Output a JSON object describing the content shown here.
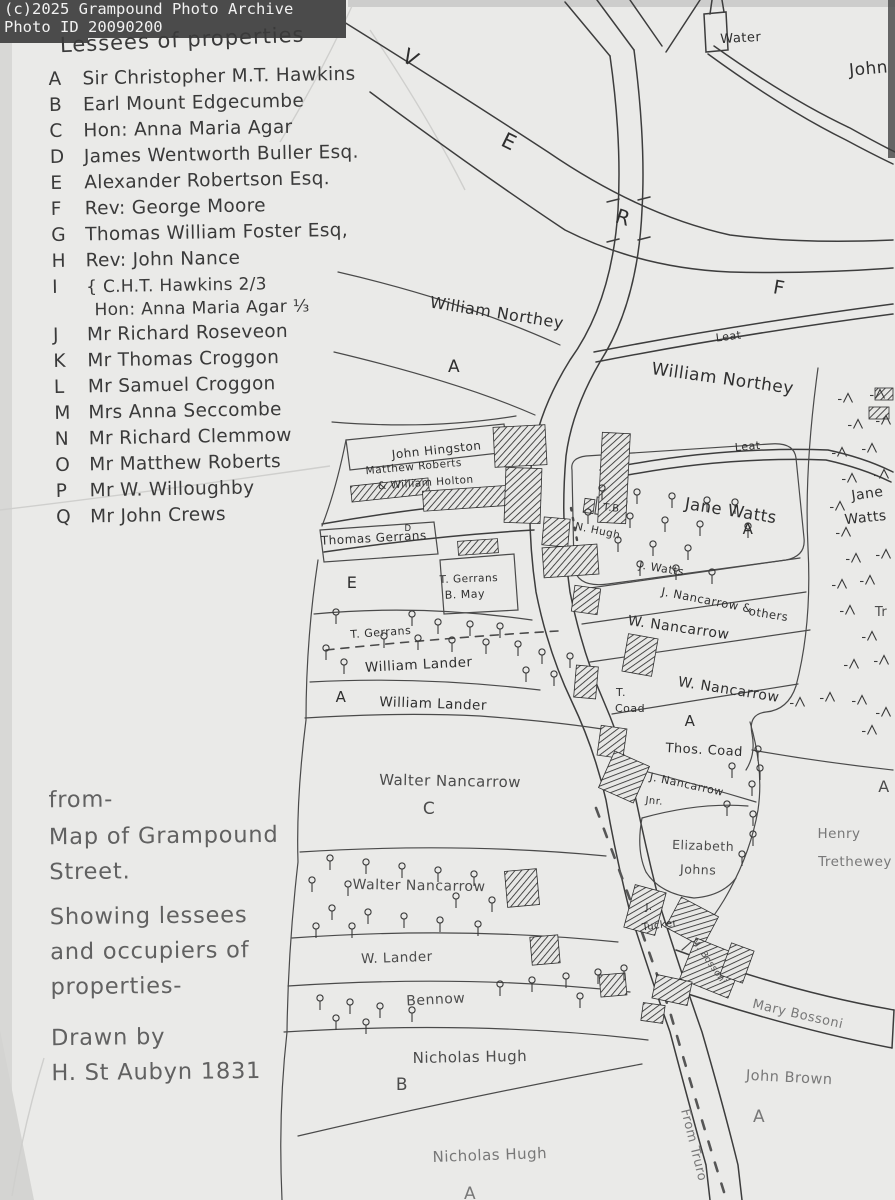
{
  "watermark": {
    "line1": "(c)2025 Grampound Photo Archive",
    "line2": "Photo ID 20090200"
  },
  "colors": {
    "ink": "#2f2f2f",
    "pencil": "#787878",
    "paper": "#eaeae8",
    "watermark_bg": "#4b4b4b",
    "watermark_text": "#f1f1f1"
  },
  "legend": {
    "title": "Lessees of properties",
    "items": [
      {
        "key": "A",
        "name": "Sir Christopher M.T. Hawkins"
      },
      {
        "key": "B",
        "name": "Earl Mount Edgecumbe"
      },
      {
        "key": "C",
        "name": "Hon: Anna Maria Agar"
      },
      {
        "key": "D",
        "name": "James Wentworth Buller Esq."
      },
      {
        "key": "E",
        "name": "Alexander Robertson Esq."
      },
      {
        "key": "F",
        "name": "Rev: George Moore"
      },
      {
        "key": "G",
        "name": "Thomas William Foster Esq,"
      },
      {
        "key": "H",
        "name": "Rev: John Nance"
      },
      {
        "key": "I",
        "name": "{ C.H.T. Hawkins 2/3",
        "name2": "Hon: Anna Maria Agar ⅓"
      },
      {
        "key": "J",
        "name": "Mr Richard Roseveon"
      },
      {
        "key": "K",
        "name": "Mr Thomas Croggon"
      },
      {
        "key": "L",
        "name": "Mr Samuel Croggon"
      },
      {
        "key": "M",
        "name": "Mrs Anna Seccombe"
      },
      {
        "key": "N",
        "name": "Mr Richard Clemmow"
      },
      {
        "key": "O",
        "name": "Mr Matthew Roberts"
      },
      {
        "key": "P",
        "name": "Mr W. Willoughby"
      },
      {
        "key": "Q",
        "name": "Mr John Crews"
      }
    ]
  },
  "note": {
    "l1": "from-",
    "l2": "Map of Grampound",
    "l3": "Street.",
    "l4": "Showing lessees",
    "l5": "and occupiers of",
    "l6": "properties-",
    "l7": "Drawn by",
    "l8": "H. St Aubyn 1831"
  },
  "map": {
    "labels": {
      "water": "Water",
      "john_top": "John",
      "river_v": "V",
      "river_e": "E",
      "river_r": "R",
      "f_field": "F",
      "northey1": "William Northey",
      "a_northey": "A",
      "leat1": "Leat",
      "northey2": "William Northey",
      "leat2": "Leat",
      "hingston": "John Hingston",
      "roberts1": "Matthew Roberts",
      "roberts2": "& William Holton",
      "tb": "T.B",
      "n_hugh": "N. Hugh",
      "jane_watts": "Jane Watts",
      "a_jane": "A",
      "j_watts": "J. Watts",
      "jane_strip1": "Jane",
      "jane_strip2": "Watts",
      "tr_partial": "Tr",
      "thomas_gerrans": "Thomas Gerrans",
      "gerrans_sup": "D",
      "e_field": "E",
      "t_gerrans_bmay1": "T. Gerrans",
      "t_gerrans_bmay2": "B. May",
      "j_nancarrow1": "J. Nancarrow &",
      "j_nancarrow2": "others",
      "w_nancarrow1": "W. Nancarrow",
      "w_nancarrow2": "W. Nancarrow",
      "t_gerrans_strip": "T. Gerrans",
      "william_lander1": "William Lander",
      "a_lander": "A",
      "william_lander2": "William Lander",
      "t_coad1": "T.",
      "t_coad2": "Coad",
      "a_coad": "A",
      "thos_coad": "Thos. Coad",
      "j_nancarrow_jnr1": "J. Nancarrow",
      "j_nancarrow_jnr2": "Jnr.",
      "elizabeth1": "Elizabeth",
      "elizabeth2": "Johns",
      "henry1": "Henry",
      "henry2": "Trethewey",
      "a_henry": "A",
      "walter1": "Walter Nancarrow",
      "c_field": "C",
      "walter2": "Walter Nancarrow",
      "w_lander": "W. Lander",
      "bennow": "Bennow",
      "nicholas1": "Nicholas Hugh",
      "b_field": "B",
      "nicholas2": "Nicholas Hugh",
      "a_bottom": "A",
      "j_tucker1": "J.",
      "j_tucker2": "Tucker",
      "m_bossoni": "M. Bossoni",
      "mary_bossoni": "Mary Bossoni",
      "john_brown": "John Brown",
      "a_brown": "A",
      "from_truro": "From Truro"
    }
  }
}
